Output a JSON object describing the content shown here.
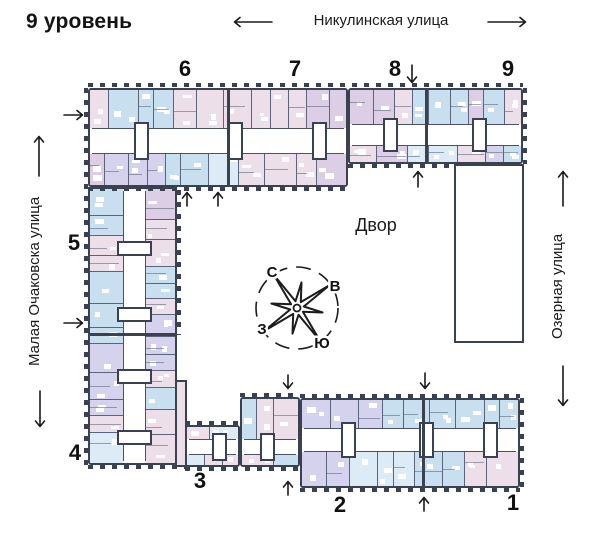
{
  "title": "9 уровень",
  "streets": {
    "top": "Никулинская улица",
    "left": "Малая Очаковска улица",
    "right": "Озерная улица"
  },
  "courtyard": "Двор",
  "compass": {
    "north": "С",
    "east": "В",
    "south": "Ю",
    "west": "З"
  },
  "sections": {
    "s1": "1",
    "s2": "2",
    "s3": "3",
    "s4": "4",
    "s5": "5",
    "s6": "6",
    "s7": "7",
    "s8": "8",
    "s9": "9"
  },
  "palette": {
    "wall": "#3a4150",
    "line": "#5b6478",
    "pink": "#ecdfe9",
    "mauve": "#dccfe5",
    "blue": "#c8dff0",
    "pale_blue": "#dcebf5",
    "lavender": "#d5d2ee",
    "corridor": "#ffffff",
    "text": "#141414"
  }
}
